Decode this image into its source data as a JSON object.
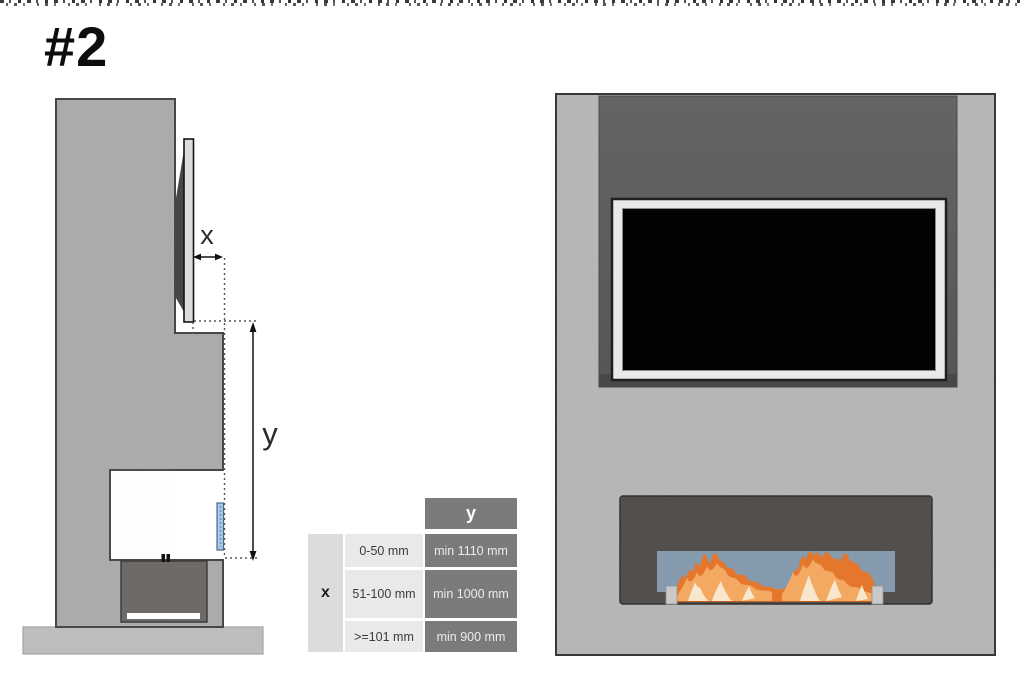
{
  "page": {
    "figure_number": "#2"
  },
  "side_view": {
    "dim_x_label": "x",
    "dim_y_label": "y"
  },
  "table": {
    "col_header_y": "y",
    "row_header_x": "x",
    "rows": [
      {
        "x_range": "0-50 mm",
        "y_min": "min 1110 mm"
      },
      {
        "x_range": "51-100 mm",
        "y_min": "min 1000 mm"
      },
      {
        "x_range": ">=101 mm",
        "y_min": "min 900 mm"
      }
    ]
  },
  "colors": {
    "table_header_dark": "#7b7b7b",
    "table_cell_light": "#dcdcdc",
    "table_cell_lighter": "#e9e9e9",
    "flame_orange": "#e4772c",
    "flame_light": "#f4a963",
    "flame_cream": "#f8e7cd",
    "glass_front_blue": "#8ca3b9",
    "glass_side_blue": "#a9cbe8"
  }
}
